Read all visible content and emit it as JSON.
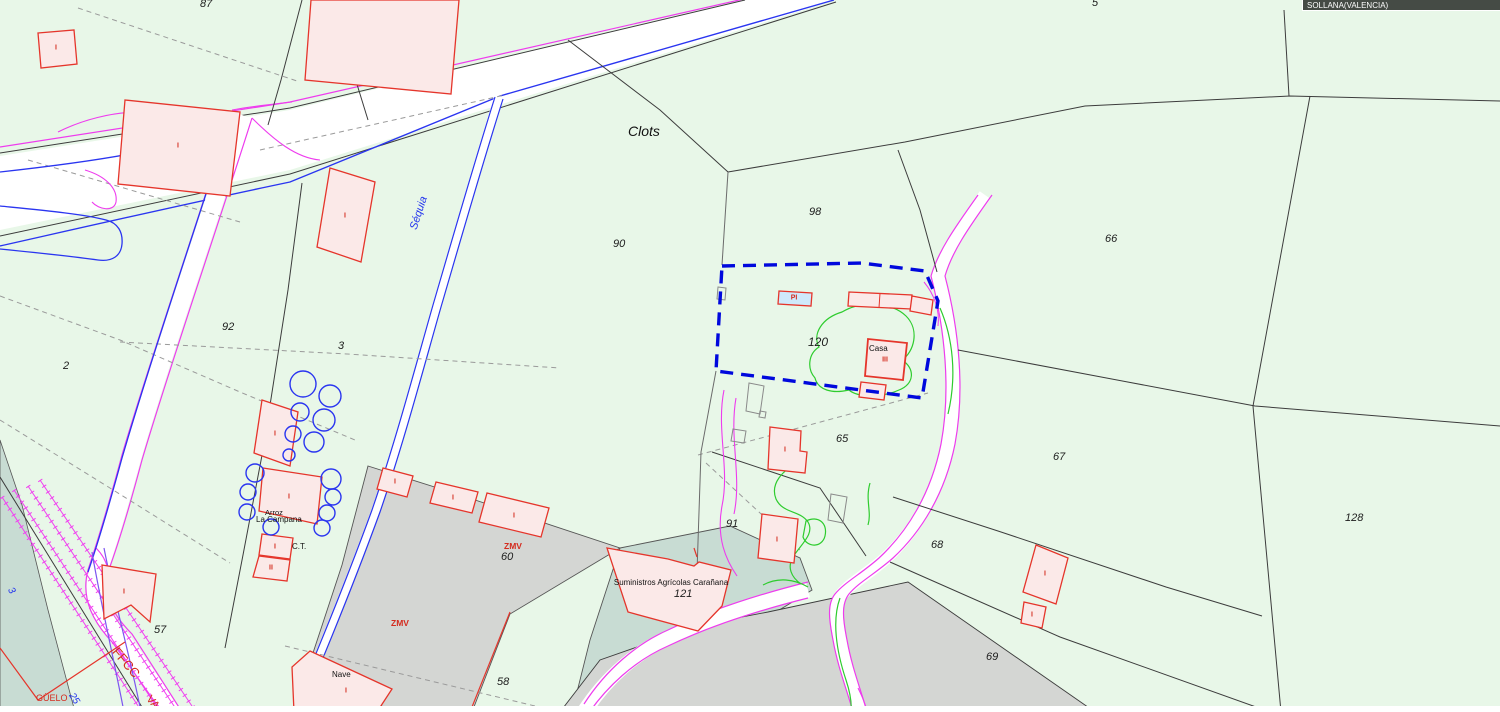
{
  "map": {
    "region_label": "SOLLANA(VALENCIA)",
    "selected_parcel": "120",
    "toponyms": {
      "clots": "Clots",
      "sequia": "Séquia",
      "casa": "Casa",
      "nave": "Nave",
      "arroz": "Arroz",
      "la_campana": "La Campana",
      "ct": "C.T.",
      "suministros": "Suministros Agrícolas Carañana",
      "ffcc": "FFCC",
      "via": "VA",
      "guelo": "GÜELO",
      "zmv_1": "ZMV",
      "zmv_2": "ZMV",
      "road_3": "3",
      "road_25": "25"
    },
    "parcel_numbers": [
      "87",
      "5",
      "2",
      "92",
      "3",
      "90",
      "98",
      "66",
      "120",
      "65",
      "67",
      "128",
      "91",
      "68",
      "69",
      "57",
      "60",
      "58",
      "121"
    ],
    "building_marks": [
      "I",
      "I",
      "I",
      "I",
      "I",
      "I",
      "II",
      "I",
      "I",
      "I",
      "I",
      "I",
      "I",
      "I",
      "I",
      "I",
      "III",
      "PI"
    ],
    "colors": {
      "background": "#e8f7e8",
      "selection_blue": "#0008dd",
      "road_magenta": "#ee3cee",
      "channel_blue": "#2a35f0",
      "vegetation_green": "#2ecc2e",
      "building_fill": "#fbe9e8",
      "building_stroke": "#e5352b",
      "pool_fill": "#cfe9fb",
      "urban_gray": "#d4d6d3",
      "teal_zone": "#c8dcd3"
    }
  }
}
